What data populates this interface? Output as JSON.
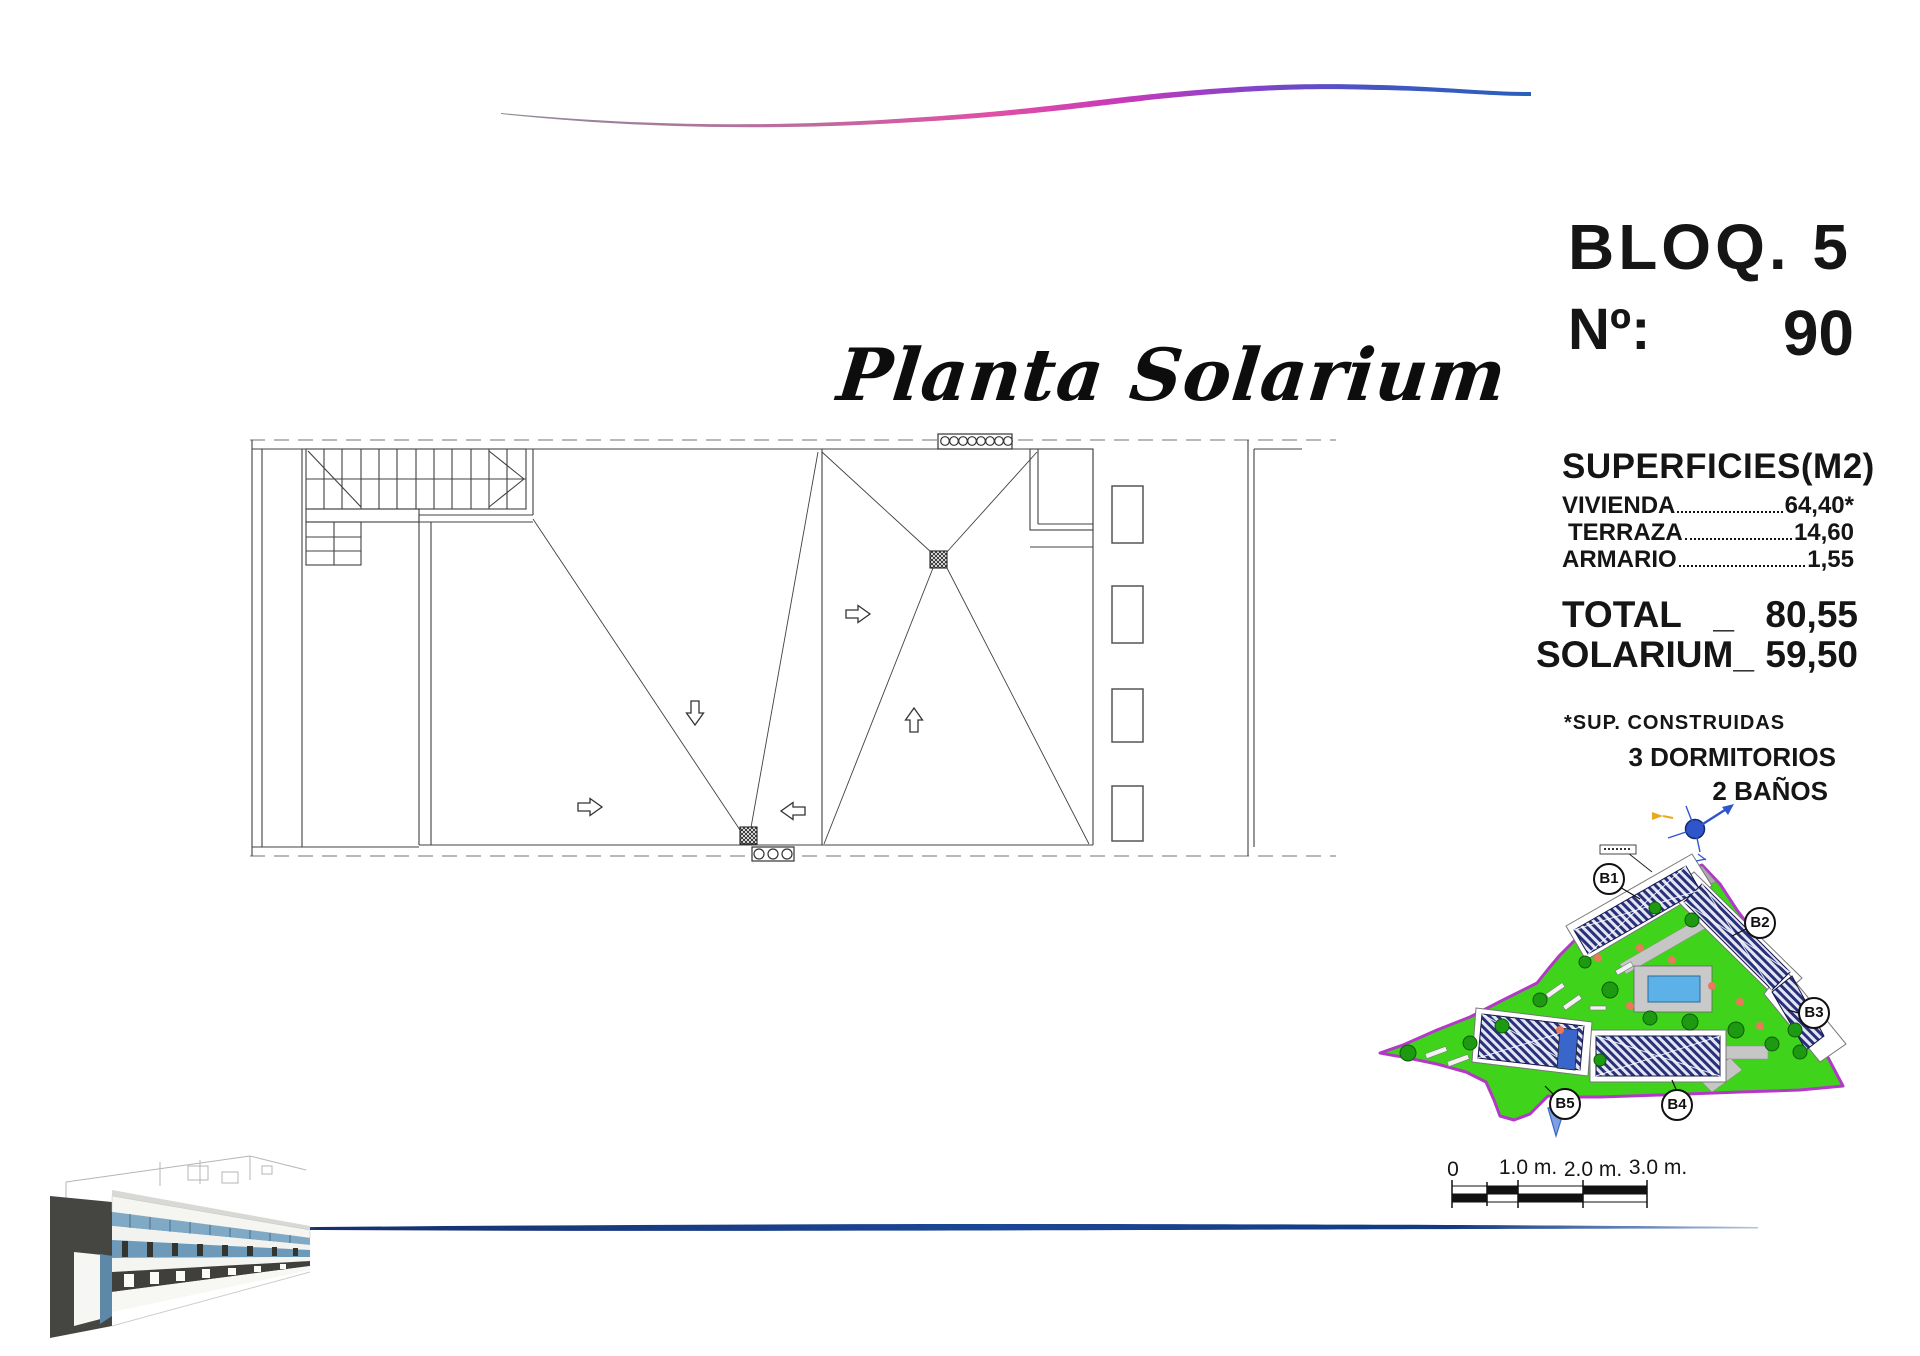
{
  "title": "Planta Solarium",
  "header": {
    "block": "BLOQ. 5",
    "number_label": "Nº:",
    "number": "90"
  },
  "surfaces": {
    "heading": "SUPERFICIES(M2)",
    "rows": [
      {
        "label": "VIVIENDA",
        "value": "64,40*"
      },
      {
        "label": "TERRAZA",
        "value": "14,60"
      },
      {
        "label": "ARMARIO",
        "value": "1,55"
      }
    ],
    "total": {
      "label": "TOTAL",
      "sep": "_",
      "value": "80,55"
    },
    "solarium": {
      "label": "SOLARIUM",
      "sep": "_",
      "value": "59,50"
    },
    "footnote": "*SUP. CONSTRUIDAS",
    "bedrooms": "3 DORMITORIOS",
    "bathrooms": "2 BAÑOS"
  },
  "scale_bar": {
    "labels": [
      "0",
      "1.0 m.",
      "2.0 m.",
      "3.0 m."
    ]
  },
  "site_plan": {
    "labels": [
      "B1",
      "B2",
      "B3",
      "B4",
      "B5"
    ]
  },
  "icons": {
    "compass": "north-arrow",
    "slope_arrows": "hollow-direction-arrow"
  },
  "colors": {
    "site_green": "#3fd41b",
    "site_boundary": "#b438c8",
    "pool_water": "#5cb2e8",
    "compass_blue": "#2f55cc",
    "bottom_line_blue": "#1c4796",
    "wave_pink": "#e04fa6",
    "wave_blue": "#2860b8",
    "roof_hatch_navy": "#28307a"
  }
}
